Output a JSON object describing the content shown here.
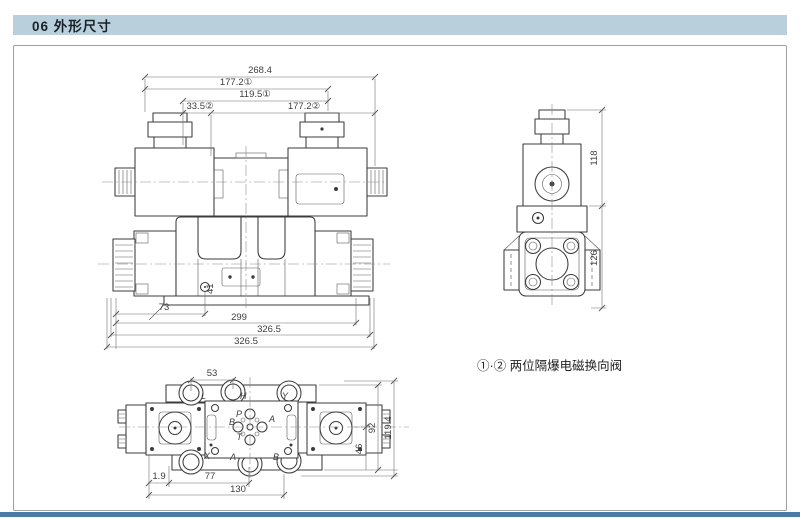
{
  "header": {
    "title": "06 外形尺寸"
  },
  "drawing": {
    "note": "①·② 两位隔爆电磁换向阀",
    "front_view": {
      "dims_top": [
        "268.4",
        "177.2①",
        "119.5①",
        "33.5②",
        "177.2②"
      ],
      "dims_bottom": [
        "73",
        "299",
        "326.5",
        "326.5"
      ],
      "hole_label": "41"
    },
    "side_view": {
      "dim_upper": "118",
      "dim_lower": "126"
    },
    "bottom_view": {
      "dim_top": "53",
      "dims_right": [
        "92",
        "46",
        "119.4"
      ],
      "dims_bottom": [
        "1.9",
        "77",
        "130"
      ],
      "ports_top": [
        "L",
        "H",
        "Y"
      ],
      "ports_center": [
        "P",
        "A",
        "B",
        "T"
      ],
      "ports_bottom": [
        "X",
        "A",
        "B"
      ]
    }
  },
  "colors": {
    "header_bg": "#b9cfdc",
    "footer_bar": "#4a7ba6",
    "line": "#3b3b3b"
  }
}
